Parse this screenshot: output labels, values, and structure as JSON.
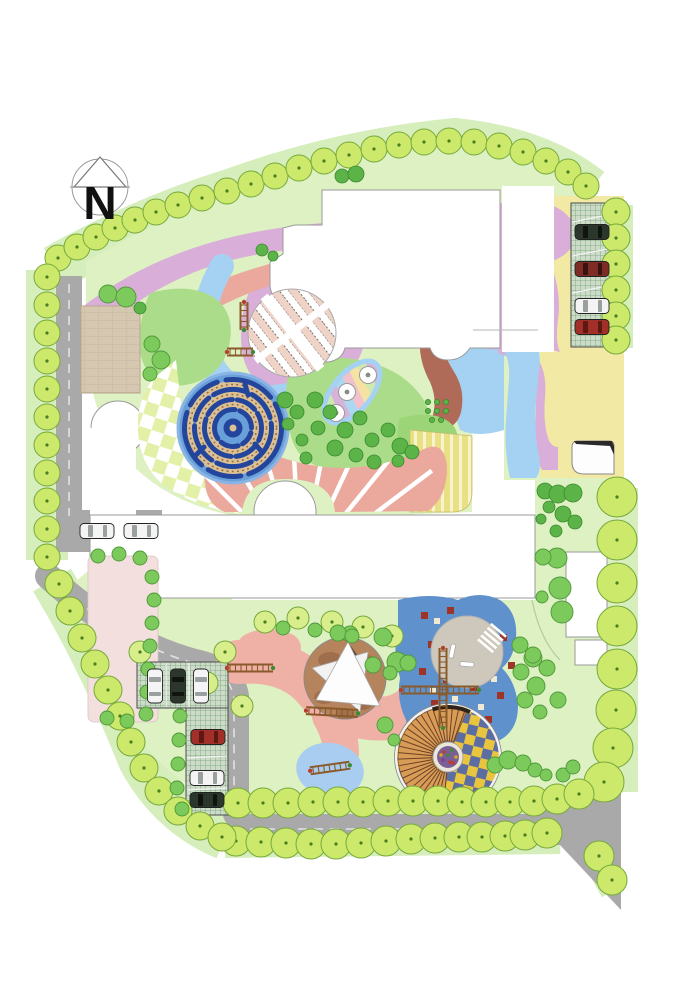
{
  "plan": {
    "north_label": "N",
    "drawing_type": "kindergarten landscape master plan"
  },
  "palette": {
    "background": "#ffffff",
    "lawn_light": "#ddf1c3",
    "lawn_band": "#d6eebb",
    "green_mid": "#abdc8a",
    "green_blob": "#9cd577",
    "tree_fill": "#cde96b",
    "tree_fill_light": "#d8ee8a",
    "tree_stroke": "#76a93c",
    "tree_dot": "#4a7d1f",
    "tree_mid_fill": "#7cc95c",
    "tree_mid_stroke": "#4e9937",
    "shrub_fill": "#5cb449",
    "shrub_stroke": "#3a8a2c",
    "salmon": "#eba89c",
    "pink_path": "#efb0a6",
    "mauve": "#d9aed9",
    "blue_light": "#a5d2f2",
    "blue_paving": "#5f92cc",
    "maze_disc": "#6aa0da",
    "maze_wall": "#24459c",
    "maze_path": "#dcc094",
    "terracotta": "#b06a58",
    "yellow_zone": "#f2e9a4",
    "yellow_stripe": "#e9e083",
    "stripe_cream": "#f7f3cf",
    "road": "#a9a9a9",
    "road_dash": "#e2e2e2",
    "parking_fill": "#ccdcc9",
    "parking_line": "#74a074",
    "plaza_tan": "#d6c7b0",
    "plaza_gray": "#cdc8bb",
    "checker_yellow": "#e9c43f",
    "checker_blue": "#5c6da1",
    "checker_fan": "#e3f0a8",
    "steps_orange": "#d99c57",
    "steps_line": "#6b4226",
    "sail_ground": "#b5835c",
    "pale_pink": "#f4dfdf",
    "car_white": "#f4f4f4",
    "car_dark": "#2c372b",
    "car_red": "#a33028",
    "car_darkred": "#7e2d26",
    "outline": "#9a9a9a",
    "north_ink": "#111111"
  },
  "features": {
    "north_arrow": "north-arrow",
    "perimeter_trees": "perimeter-trees",
    "maze": "circular-maze",
    "checker_plaza": "checker-plaza-with-spiral-steps",
    "sail_plaza": "shade-sail-plaza",
    "leaf_plaza": "leaf-striped-plaza",
    "play_ribbon": "pink-play-ribbon",
    "blue_paving": "blue-play-paving",
    "parking_north": "parking-north",
    "parking_south": "parking-south",
    "roads": "site-roads",
    "buildings": "building-footprints"
  }
}
